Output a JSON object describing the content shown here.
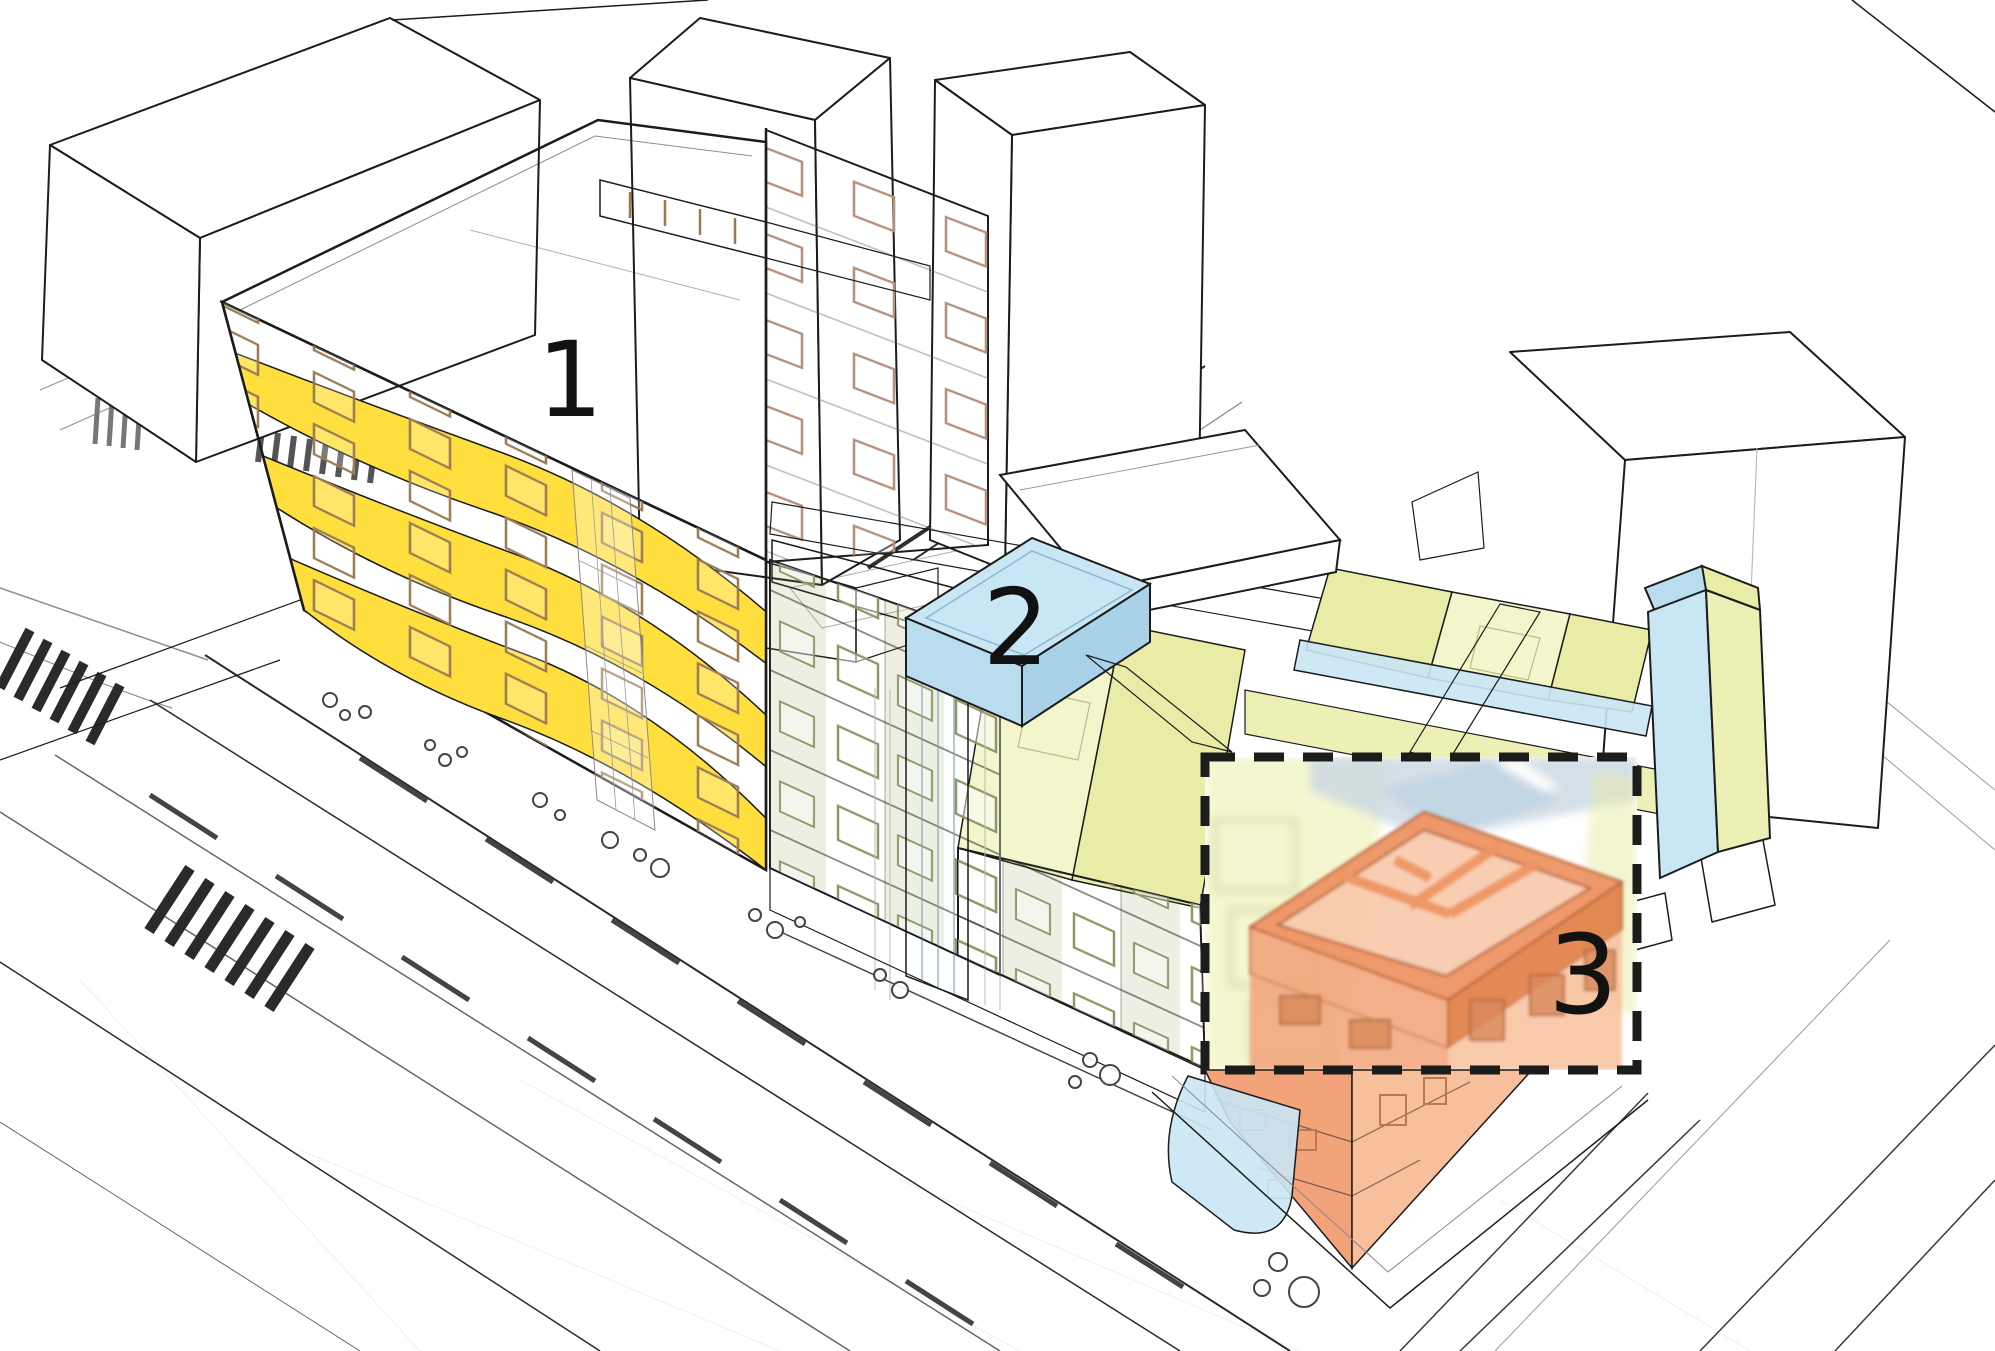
{
  "title": "Axonometric urban massing diagram with three numbered building zones",
  "labels": {
    "block1": "1",
    "block2": "2",
    "block3": "3"
  },
  "blocks": [
    {
      "id": 1,
      "label": "1",
      "highlight": "orange overlay"
    },
    {
      "id": 2,
      "label": "2",
      "highlight": "light blue rooftop volume"
    },
    {
      "id": 3,
      "label": "3",
      "highlight": "dashed detail box with cut-away unit"
    }
  ],
  "callout": {
    "shape": "dashed-rectangle",
    "label": "3"
  },
  "colors": {
    "ink": "#1c1c1c",
    "line_soft": "#8f8f8f",
    "line_faint": "#dddddd",
    "white": "#ffffff",
    "salmon": "#f6ab89",
    "salmon_face": "#f8b794",
    "pink_gable": "#fad3bf",
    "yellow": "#ffdf3d",
    "yellow_pale": "#ffe98f",
    "green_light": "#f3f5cb",
    "green_mid": "#e8eca6",
    "green_face": "#edf0b5",
    "blue": "#c9e6f5",
    "blue_mid": "#b9dcef",
    "blue_deep": "#a9d2e9",
    "wall_orange": "#ee9564",
    "wall_orange_deep": "#e0793f",
    "wall_stroke": "#b05a2e",
    "detail_orange_left": "#f2a379",
    "detail_orange_right": "#f8bf9c",
    "label_color": "#111111"
  }
}
